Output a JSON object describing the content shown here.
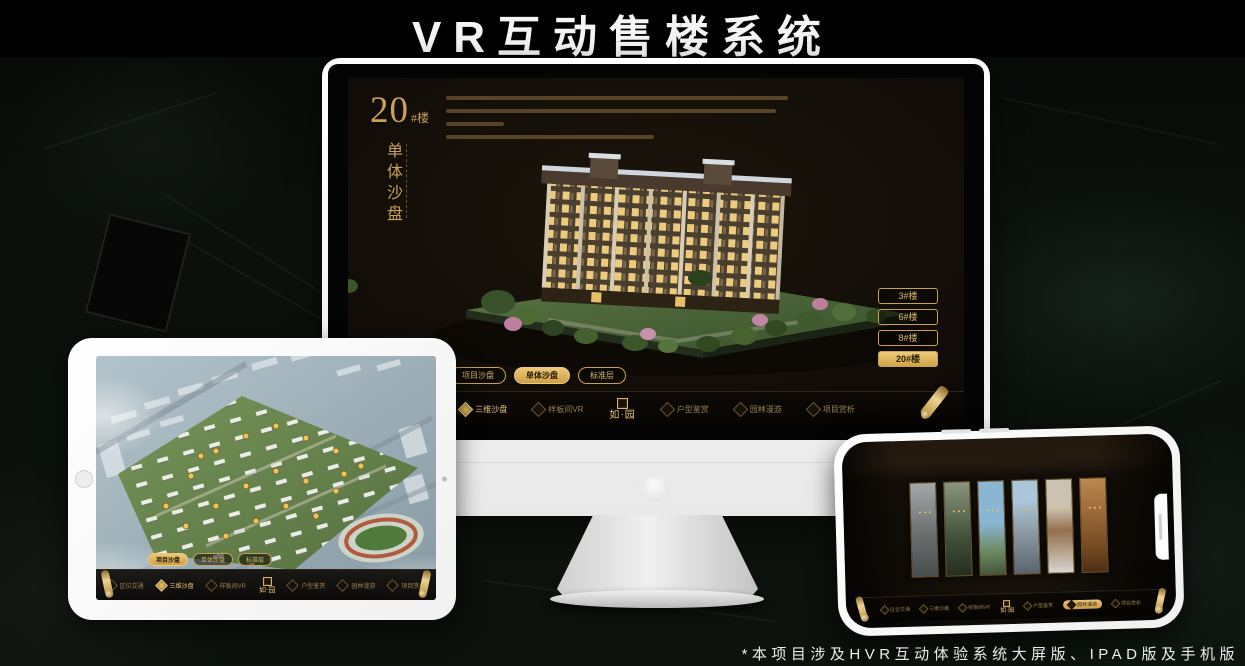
{
  "page": {
    "title": "VR互动售楼系统",
    "footnote": "*本项目涉及HVR互动体验系统大屏版、IPAD版及手机版"
  },
  "colors": {
    "accent_gold": "#d7b266",
    "active_fill_gold": "#e3bc66",
    "screen_background": "#16100a",
    "page_background": "#0b100c",
    "headline_white": "#f5f5f5"
  },
  "system": {
    "logo_text": "如·园",
    "view_tabs": [
      "项目沙盘",
      "单体沙盘",
      "标准层"
    ],
    "nav_items": [
      "区位交通",
      "三维沙盘",
      "样板间VR",
      "户型鉴赏",
      "园林漫游",
      "项目赏析"
    ]
  },
  "monitor_screen": {
    "building_number": "20",
    "building_number_suffix": "#楼",
    "section_title_vertical": "单体沙盘",
    "active_view_tab": "单体沙盘",
    "active_nav_item": "三维沙盘",
    "floor_buttons": [
      "3#楼",
      "6#楼",
      "8#楼",
      "20#楼"
    ],
    "active_floor_button": "20#楼"
  },
  "ipad_screen": {
    "active_view_tab": "项目沙盘",
    "active_nav_item": "三维沙盘"
  },
  "phone_screen": {
    "active_nav_item": "园林漫游",
    "scene_panel_count": 6
  }
}
